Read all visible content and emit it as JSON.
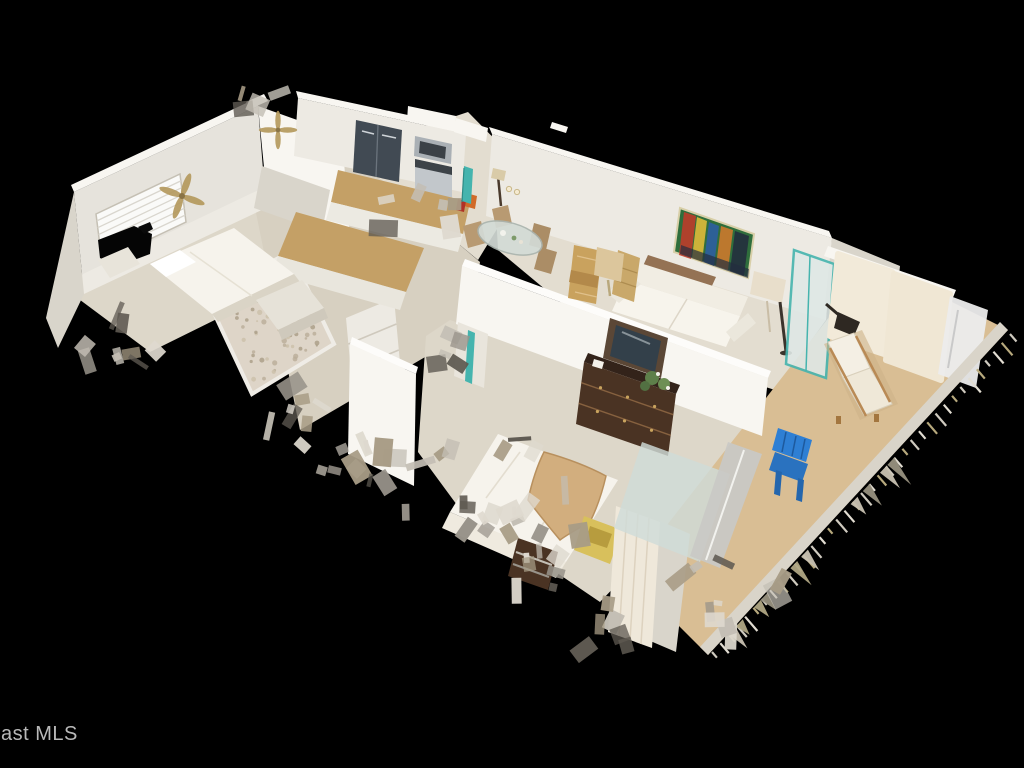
{
  "image": {
    "type": "3d-dollhouse-cutaway-view",
    "description": "Overhead Matterport-style 3D dollhouse scan of a condo interior floating on a black background, viewed from above at an angle; ragged scan edges around the perimeter"
  },
  "watermark": {
    "text": "ast MLS"
  },
  "colors": {
    "background": "#000000",
    "watermark_color": "#c9c9c9",
    "wall": "#edeae3",
    "wall_bright": "#f8f6f1",
    "wall_shade": "#d9d5cb",
    "wall_dark": "#c5c0b4",
    "floor": "#ddd7c9",
    "floor_bright": "#e3ddd0",
    "floor_hall": "#d7d0c1",
    "balcony_floor": "#d9be94",
    "counter": "#c4a066",
    "fridge": "#414a53",
    "steel": "#aab0b5",
    "wood_dark": "#4a3323",
    "wood_mid": "#8a6544",
    "wood_light": "#c49a62",
    "linen": "#f6f3ec",
    "throw_tan": "#d2ae7e",
    "chair_blue": "#2e7fd4",
    "accent_teal": "#45b4ae",
    "chair_yellow": "#d8c05c",
    "plant_green": "#5e7f4a",
    "glass": "#cfdcd8",
    "painting": [
      "#2f6e3c",
      "#c23b2a",
      "#e2bd3a",
      "#2e5fa3",
      "#d07a2c",
      "#232e3e"
    ]
  },
  "scene": {
    "rooms": [
      {
        "name": "guest-bedroom",
        "contents": [
          "white bed",
          "nightstand",
          "dresser",
          "ceiling fan",
          "window with blinds",
          "scan hole in window"
        ]
      },
      {
        "name": "bathroom-hall",
        "contents": [
          "pebbled glass shower",
          "white shelving unit",
          "vanity"
        ]
      },
      {
        "name": "kitchen",
        "contents": [
          "stainless refrigerator",
          "microwave",
          "stove",
          "granite counter",
          "island",
          "teal entry door"
        ]
      },
      {
        "name": "dining-area",
        "contents": [
          "glass dining table",
          "four beige chairs",
          "floor lamp",
          "wall sconces"
        ]
      },
      {
        "name": "living-room",
        "contents": [
          "colorful abstract painting",
          "white leather sofa",
          "bentwood chair",
          "beige table lamp",
          "drum floor lamp",
          "teal framed slider"
        ]
      },
      {
        "name": "master-bedroom",
        "contents": [
          "bed with tan throw",
          "dark wood dresser with mirror",
          "plant",
          "yellow chair",
          "dark nightstand",
          "cream curtain panel"
        ]
      },
      {
        "name": "balcony",
        "contents": [
          "chaise lounge with white cushion",
          "blue slatted chair",
          "cream privacy wall panels",
          "metal railing with balusters",
          "tan floor"
        ]
      }
    ]
  }
}
